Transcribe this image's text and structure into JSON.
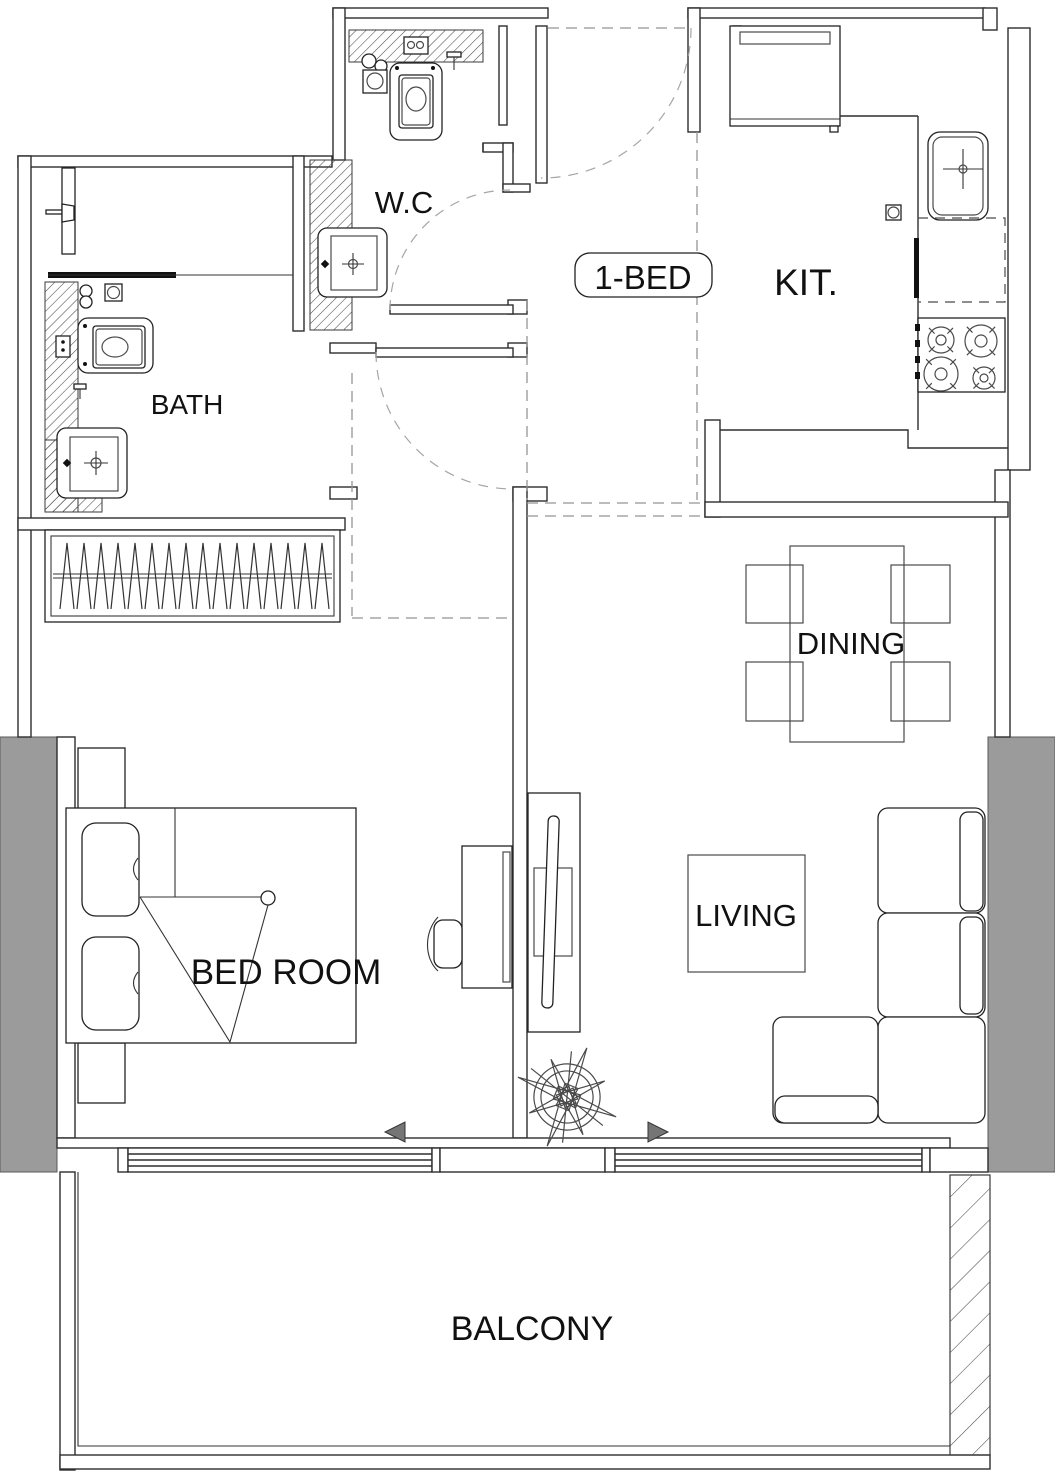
{
  "title": "1-bedroom apartment floor plan",
  "unit": {
    "label": "1-BED"
  },
  "rooms": {
    "wc": "W.C",
    "kitchen": "KIT.",
    "bath": "BATH",
    "dining": "DINING",
    "living": "LIVING",
    "bedroom": "BED ROOM",
    "balcony": "BALCONY"
  },
  "symbols": {
    "compass": "compass-rose",
    "bedroom_arrow": "left-triangle",
    "living_arrow": "right-triangle"
  },
  "colors": {
    "line": "#2e2e2e",
    "column_fill": "#9b9b9b",
    "dashed": "#949494",
    "text": "#111111",
    "background": "#ffffff"
  }
}
